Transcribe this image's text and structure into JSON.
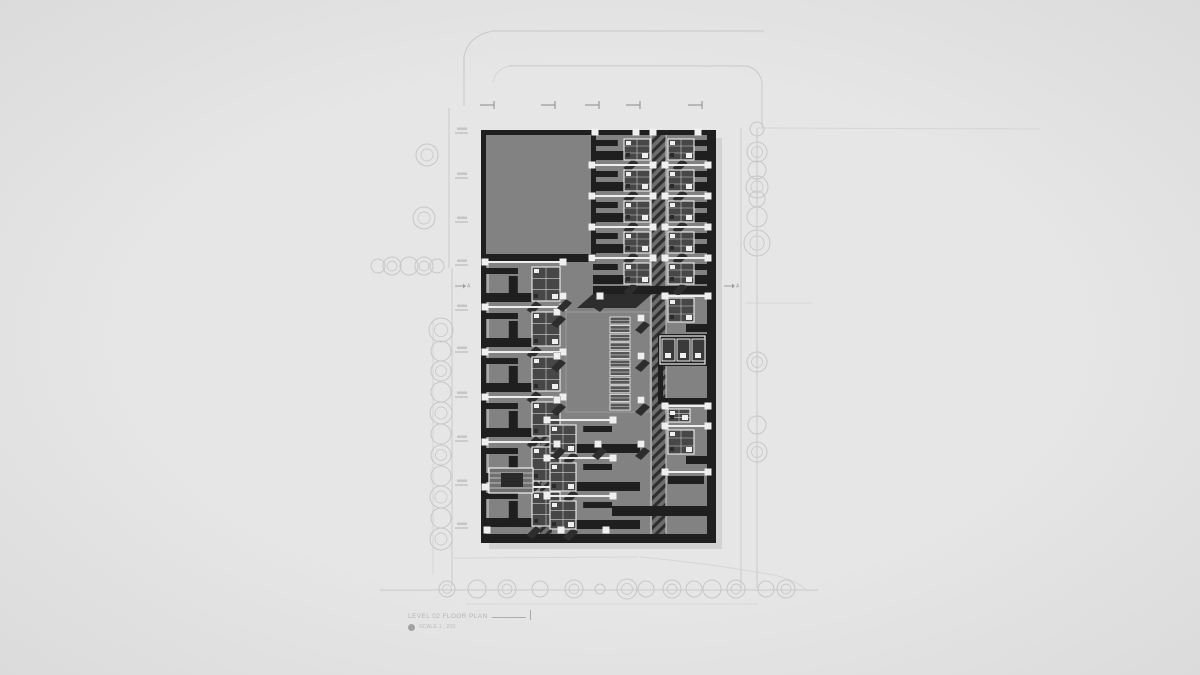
{
  "meta": {
    "drawing_type": "architectural floor plan site drawing",
    "style": "grayscale axonometric-shadow plan"
  },
  "colors": {
    "bg": "#e4e4e4",
    "road": "#c9c9c9",
    "road_faint": "#d6d6d6",
    "tree": "#c7c7c7",
    "marker": "#9f9f9f",
    "tick": "#b3b3b3",
    "tick_label": "#c6c6c6",
    "floor": "#828282",
    "wall": "#1f1f1f",
    "hatch_base": "#6d6d6d",
    "hatch_line": "#2e2e2e",
    "white": "#efefef",
    "pod_fill": "#474747",
    "pod_line": "#cfcfcf",
    "shadow": "#2d2d2d",
    "outer_shadow": "#d3d3d3",
    "courtyard_line": "#9a9a9a",
    "edge_white": "#d6d6d6"
  },
  "title_block": {
    "title": "LEVEL 02 FLOOR PLAN",
    "scale_label": "SCALE 1 : 200"
  },
  "site": {
    "roads_main": [
      "M493,31 L764,31",
      "M493,31 Q469,35 464,56 L464,106",
      "M509,66 L747,66",
      "M747,66 Q759,69 762,82 L762,128",
      "M449,108 L449,268",
      "M452,268 L452,586",
      "M741,128 L741,588",
      "M757,128 L757,588",
      "M380,590 L818,590"
    ],
    "roads_faint": [
      "M509,66 Q496,69 493,82",
      "M757,128 L1040,129",
      "M745,303 L812,303",
      "M433,320 L433,574",
      "M454,558 L638,557",
      "M640,557 Q706,563 768,574 Q796,579 806,590",
      "M466,604 L758,604"
    ],
    "top_markers": {
      "y": 105,
      "xs": [
        492,
        553,
        597,
        638,
        700
      ]
    },
    "left_ticks": {
      "x": 455,
      "ys": [
        133,
        178,
        222,
        265,
        310,
        352,
        397,
        441,
        485,
        528
      ]
    },
    "section_markers": [
      {
        "x": 462,
        "y": 286,
        "label": "A"
      },
      {
        "x": 731,
        "y": 286,
        "label": "A"
      }
    ],
    "trees": [
      [
        427,
        155,
        11,
        1
      ],
      [
        424,
        218,
        11,
        1
      ],
      [
        378,
        266,
        7,
        0
      ],
      [
        392,
        266,
        9,
        1
      ],
      [
        409,
        266,
        9,
        0
      ],
      [
        424,
        266,
        9,
        1
      ],
      [
        437,
        266,
        7,
        0
      ],
      [
        441,
        330,
        12,
        1
      ],
      [
        441,
        351,
        10,
        0
      ],
      [
        441,
        371,
        10,
        1
      ],
      [
        441,
        392,
        10,
        0
      ],
      [
        441,
        413,
        11,
        1
      ],
      [
        441,
        434,
        10,
        0
      ],
      [
        441,
        455,
        10,
        1
      ],
      [
        441,
        476,
        10,
        0
      ],
      [
        441,
        497,
        11,
        1
      ],
      [
        441,
        518,
        10,
        0
      ],
      [
        441,
        539,
        11,
        1
      ],
      [
        757,
        129,
        7,
        0
      ],
      [
        757,
        152,
        10,
        1
      ],
      [
        757,
        170,
        9,
        0
      ],
      [
        757,
        187,
        11,
        1
      ],
      [
        757,
        199,
        8,
        0
      ],
      [
        757,
        217,
        10,
        0
      ],
      [
        757,
        243,
        13,
        1
      ],
      [
        757,
        362,
        10,
        1
      ],
      [
        757,
        425,
        9,
        0
      ],
      [
        757,
        452,
        10,
        1
      ],
      [
        447,
        589,
        8,
        1
      ],
      [
        477,
        589,
        9,
        0
      ],
      [
        507,
        589,
        9,
        1
      ],
      [
        540,
        589,
        8,
        0
      ],
      [
        574,
        589,
        9,
        1
      ],
      [
        600,
        589,
        5,
        0
      ],
      [
        627,
        589,
        10,
        1
      ],
      [
        646,
        589,
        8,
        0
      ],
      [
        672,
        589,
        9,
        1
      ],
      [
        694,
        589,
        8,
        0
      ],
      [
        712,
        589,
        9,
        0
      ],
      [
        736,
        589,
        9,
        1
      ],
      [
        766,
        589,
        8,
        0
      ],
      [
        786,
        589,
        9,
        1
      ]
    ]
  },
  "building": {
    "outer_shadow": [
      489,
      138,
      233,
      411
    ],
    "floor": [
      483,
      132,
      228,
      406
    ],
    "perimeter_walls": [
      [
        481,
        130,
        235,
        5
      ],
      [
        481,
        130,
        5,
        413
      ],
      [
        707,
        130,
        9,
        413
      ],
      [
        481,
        534,
        235,
        9
      ]
    ],
    "inner_walls": [
      [
        486,
        254,
        107,
        8
      ],
      [
        591,
        135,
        5,
        127
      ],
      [
        593,
        286,
        114,
        8
      ],
      [
        612,
        506,
        95,
        10
      ],
      [
        658,
        334,
        49,
        32
      ],
      [
        658,
        366,
        5,
        36
      ],
      [
        658,
        398,
        49,
        6
      ]
    ],
    "hatch_rects": [
      [
        652,
        135,
        14,
        399
      ],
      [
        540,
        421,
        12,
        113
      ]
    ],
    "shadow_polys": [
      [
        [
          593,
          294
        ],
        [
          652,
          294
        ],
        [
          636,
          308
        ],
        [
          577,
          308
        ]
      ]
    ],
    "white_edge_lines": [
      [
        488,
        262,
        488,
        532
      ],
      [
        651,
        135,
        651,
        534
      ],
      [
        666,
        135,
        666,
        534
      ]
    ],
    "bands": [
      {
        "x": 593,
        "w": 59,
        "y": 134,
        "n": 5,
        "uh": 31,
        "pod_side": "right",
        "pod": [
          26,
          22
        ]
      },
      {
        "x": 666,
        "w": 41,
        "y": 134,
        "n": 5,
        "uh": 31,
        "pod_side": "left",
        "pod": [
          26,
          22
        ]
      },
      {
        "x": 486,
        "w": 76,
        "y": 262,
        "n": 6,
        "uh": 45,
        "pod_side": "right",
        "pod": [
          28,
          34
        ]
      },
      {
        "x": 548,
        "w": 64,
        "y": 420,
        "n": 3,
        "uh": 38,
        "pod_side": "left",
        "pod": [
          26,
          30
        ],
        "wall_ext": 92
      }
    ],
    "columns": [
      [
        557,
        312
      ],
      [
        557,
        356
      ],
      [
        557,
        400
      ],
      [
        557,
        444
      ],
      [
        641,
        318
      ],
      [
        641,
        356
      ],
      [
        641,
        400
      ],
      [
        641,
        444
      ],
      [
        598,
        444
      ],
      [
        563,
        296
      ],
      [
        600,
        296
      ]
    ],
    "courtyard": [
      566,
      312,
      84,
      100
    ],
    "ladder": {
      "x": 610,
      "y": 317,
      "w": 20,
      "rh": 7,
      "gap": 1.6,
      "n": 11
    },
    "elevator_core": {
      "frame": [
        660,
        336,
        45,
        28
      ],
      "cells_y": 339,
      "cells_x": [
        662,
        677,
        692
      ],
      "cw": 13,
      "ch": 22
    },
    "extra_dividers": [
      [
        666,
        296,
        707
      ],
      [
        666,
        406,
        707
      ],
      [
        666,
        426,
        707
      ],
      [
        666,
        472,
        707
      ]
    ],
    "extra_pods": [
      [
        668,
        298,
        26,
        24
      ],
      [
        668,
        409,
        22,
        13
      ],
      [
        668,
        430,
        26,
        24
      ]
    ],
    "extra_walls": [
      [
        686,
        324,
        21,
        8
      ],
      [
        686,
        456,
        21,
        8
      ],
      [
        668,
        476,
        36,
        8
      ]
    ],
    "louver_box": [
      489,
      468,
      44,
      25
    ],
    "top_squares": {
      "y": 132,
      "xs": [
        595,
        636,
        653,
        698
      ]
    },
    "bottom_squares": {
      "y": 530,
      "xs": [
        487,
        561,
        606
      ]
    }
  }
}
